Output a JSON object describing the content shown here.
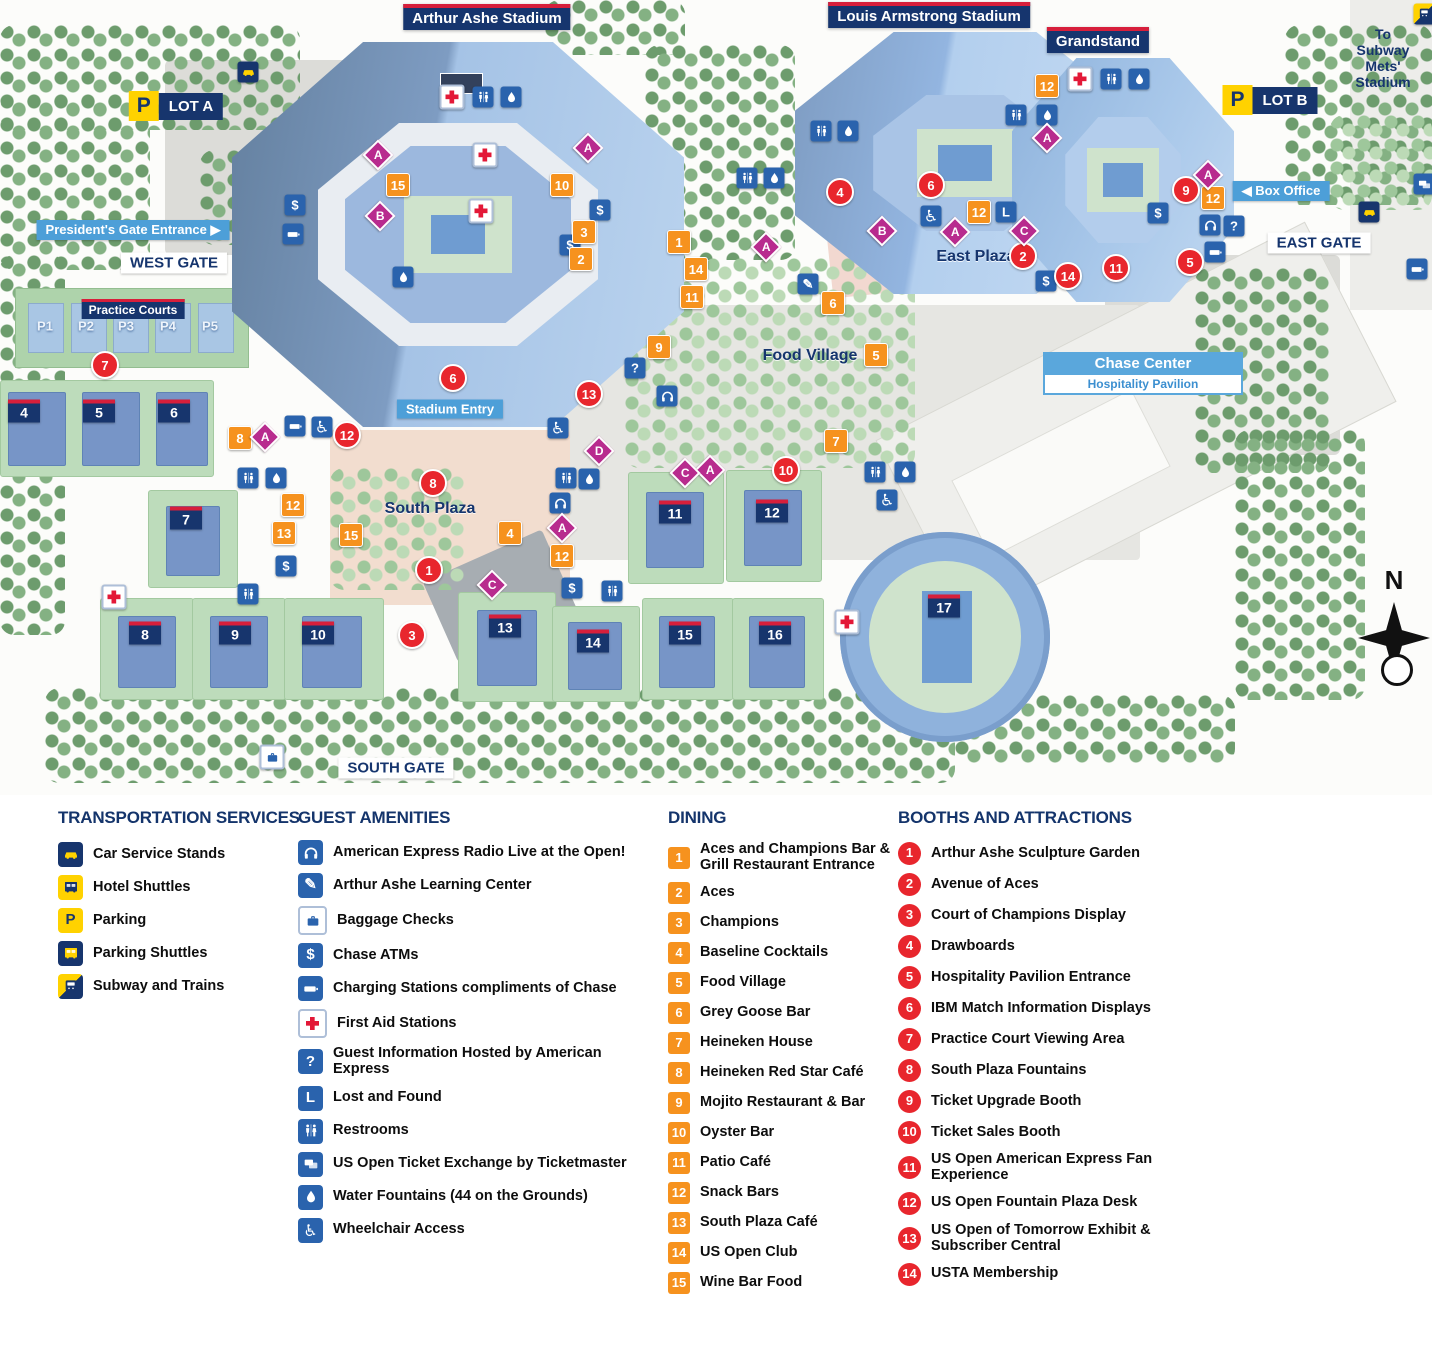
{
  "map": {
    "chase": {
      "line1": "Chase Center",
      "line2": "Hospitality Pavilion"
    },
    "compass": {
      "n": "N"
    },
    "labels": [
      {
        "id": "arthur-ashe-stadium-title",
        "style": "title",
        "text": "Arthur Ashe Stadium",
        "x": 487,
        "y": 17
      },
      {
        "id": "louis-armstrong-stadium-title",
        "style": "title",
        "text": "Louis Armstrong Stadium",
        "x": 929,
        "y": 15
      },
      {
        "id": "grandstand-title",
        "style": "title",
        "text": "Grandstand",
        "x": 1098,
        "y": 40
      },
      {
        "id": "practice-courts-title",
        "style": "title-sm",
        "text": "Practice Courts",
        "x": 133,
        "y": 309
      },
      {
        "id": "west-gate-label",
        "style": "gate",
        "text": "WEST GATE",
        "x": 174,
        "y": 263
      },
      {
        "id": "east-gate-label",
        "style": "gate",
        "text": "EAST GATE",
        "x": 1319,
        "y": 243
      },
      {
        "id": "south-gate-label",
        "style": "gate",
        "text": "SOUTH GATE",
        "x": 396,
        "y": 768
      },
      {
        "id": "presidents-gate-entrance-label",
        "style": "blue",
        "text": "President's Gate Entrance ▶",
        "x": 133,
        "y": 230
      },
      {
        "id": "stadium-entry-label",
        "style": "blue",
        "text": "Stadium Entry",
        "x": 450,
        "y": 409
      },
      {
        "id": "box-office-label",
        "style": "blue",
        "text": "◀ Box Office",
        "x": 1281,
        "y": 191
      },
      {
        "id": "east-plaza-label",
        "style": "plaza",
        "text": "East Plaza",
        "x": 976,
        "y": 257
      },
      {
        "id": "south-plaza-label",
        "style": "plaza",
        "text": "South Plaza",
        "x": 430,
        "y": 509
      },
      {
        "id": "food-village-label",
        "style": "plaza",
        "text": "Food Village",
        "x": 810,
        "y": 356
      },
      {
        "id": "to-subway-label",
        "style": "navytext",
        "text": "To Subway\nMets' Stadium",
        "x": 1383,
        "y": 58
      },
      {
        "id": "lot-a-label",
        "style": "lot",
        "text": "LOT A",
        "x": 176,
        "y": 106
      },
      {
        "id": "lot-b-label",
        "style": "lot",
        "text": "LOT B",
        "x": 1270,
        "y": 100
      }
    ],
    "courts": [
      {
        "n": "4",
        "x": 24,
        "y": 411
      },
      {
        "n": "5",
        "x": 99,
        "y": 411
      },
      {
        "n": "6",
        "x": 174,
        "y": 411
      },
      {
        "n": "7",
        "x": 186,
        "y": 518
      },
      {
        "n": "8",
        "x": 145,
        "y": 633
      },
      {
        "n": "9",
        "x": 235,
        "y": 633
      },
      {
        "n": "10",
        "x": 318,
        "y": 633
      },
      {
        "n": "11",
        "x": 675,
        "y": 512
      },
      {
        "n": "12",
        "x": 772,
        "y": 511
      },
      {
        "n": "13",
        "x": 505,
        "y": 626
      },
      {
        "n": "14",
        "x": 593,
        "y": 641
      },
      {
        "n": "15",
        "x": 685,
        "y": 633
      },
      {
        "n": "16",
        "x": 775,
        "y": 633
      },
      {
        "n": "17",
        "x": 944,
        "y": 606
      }
    ],
    "practice_courts": [
      {
        "t": "P1",
        "x": 45,
        "y": 326
      },
      {
        "t": "P2",
        "x": 86,
        "y": 326
      },
      {
        "t": "P3",
        "x": 126,
        "y": 326
      },
      {
        "t": "P4",
        "x": 168,
        "y": 326
      },
      {
        "t": "P5",
        "x": 210,
        "y": 326
      }
    ],
    "markers": [
      {
        "k": "d",
        "v": "15",
        "x": 398,
        "y": 185
      },
      {
        "k": "d",
        "v": "10",
        "x": 562,
        "y": 185
      },
      {
        "k": "d",
        "v": "3",
        "x": 584,
        "y": 232
      },
      {
        "k": "d",
        "v": "2",
        "x": 581,
        "y": 259
      },
      {
        "k": "d",
        "v": "1",
        "x": 679,
        "y": 242
      },
      {
        "k": "d",
        "v": "14",
        "x": 696,
        "y": 269
      },
      {
        "k": "d",
        "v": "11",
        "x": 692,
        "y": 297
      },
      {
        "k": "d",
        "v": "9",
        "x": 659,
        "y": 347
      },
      {
        "k": "d",
        "v": "8",
        "x": 240,
        "y": 438
      },
      {
        "k": "d",
        "v": "12",
        "x": 293,
        "y": 505
      },
      {
        "k": "d",
        "v": "13",
        "x": 284,
        "y": 533
      },
      {
        "k": "d",
        "v": "15",
        "x": 351,
        "y": 535
      },
      {
        "k": "d",
        "v": "4",
        "x": 510,
        "y": 533
      },
      {
        "k": "d",
        "v": "12",
        "x": 562,
        "y": 556
      },
      {
        "k": "d",
        "v": "6",
        "x": 833,
        "y": 303
      },
      {
        "k": "d",
        "v": "5",
        "x": 876,
        "y": 355
      },
      {
        "k": "d",
        "v": "7",
        "x": 836,
        "y": 441
      },
      {
        "k": "d",
        "v": "12",
        "x": 1047,
        "y": 86
      },
      {
        "k": "d",
        "v": "12",
        "x": 979,
        "y": 212
      },
      {
        "k": "d",
        "v": "12",
        "x": 1213,
        "y": 198
      },
      {
        "k": "b",
        "v": "7",
        "x": 105,
        "y": 365
      },
      {
        "k": "b",
        "v": "6",
        "x": 453,
        "y": 378
      },
      {
        "k": "b",
        "v": "13",
        "x": 589,
        "y": 394
      },
      {
        "k": "b",
        "v": "12",
        "x": 347,
        "y": 435
      },
      {
        "k": "b",
        "v": "8",
        "x": 433,
        "y": 483
      },
      {
        "k": "b",
        "v": "1",
        "x": 429,
        "y": 570
      },
      {
        "k": "b",
        "v": "3",
        "x": 412,
        "y": 635
      },
      {
        "k": "b",
        "v": "10",
        "x": 786,
        "y": 470
      },
      {
        "k": "b",
        "v": "4",
        "x": 840,
        "y": 192
      },
      {
        "k": "b",
        "v": "6",
        "x": 931,
        "y": 185
      },
      {
        "k": "b",
        "v": "2",
        "x": 1023,
        "y": 256
      },
      {
        "k": "b",
        "v": "14",
        "x": 1068,
        "y": 276
      },
      {
        "k": "b",
        "v": "11",
        "x": 1116,
        "y": 268
      },
      {
        "k": "b",
        "v": "9",
        "x": 1186,
        "y": 190
      },
      {
        "k": "b",
        "v": "5",
        "x": 1190,
        "y": 262
      },
      {
        "k": "a",
        "v": "firstaid",
        "x": 452,
        "y": 97
      },
      {
        "k": "a",
        "v": "firstaid",
        "x": 485,
        "y": 155
      },
      {
        "k": "a",
        "v": "firstaid",
        "x": 481,
        "y": 211
      },
      {
        "k": "a",
        "v": "firstaid",
        "x": 1080,
        "y": 79
      },
      {
        "k": "a",
        "v": "firstaid",
        "x": 114,
        "y": 597
      },
      {
        "k": "a",
        "v": "firstaid",
        "x": 847,
        "y": 622
      },
      {
        "k": "a",
        "v": "restroom",
        "x": 483,
        "y": 97
      },
      {
        "k": "a",
        "v": "restroom",
        "x": 821,
        "y": 131
      },
      {
        "k": "a",
        "v": "restroom",
        "x": 747,
        "y": 178
      },
      {
        "k": "a",
        "v": "restroom",
        "x": 1016,
        "y": 115
      },
      {
        "k": "a",
        "v": "restroom",
        "x": 1111,
        "y": 79
      },
      {
        "k": "a",
        "v": "restroom",
        "x": 248,
        "y": 478
      },
      {
        "k": "a",
        "v": "restroom",
        "x": 566,
        "y": 478
      },
      {
        "k": "a",
        "v": "restroom",
        "x": 875,
        "y": 472
      },
      {
        "k": "a",
        "v": "restroom",
        "x": 248,
        "y": 594
      },
      {
        "k": "a",
        "v": "restroom",
        "x": 612,
        "y": 591
      },
      {
        "k": "a",
        "v": "water",
        "x": 511,
        "y": 97
      },
      {
        "k": "a",
        "v": "water",
        "x": 403,
        "y": 277
      },
      {
        "k": "a",
        "v": "water",
        "x": 848,
        "y": 131
      },
      {
        "k": "a",
        "v": "water",
        "x": 774,
        "y": 178
      },
      {
        "k": "a",
        "v": "water",
        "x": 1047,
        "y": 115
      },
      {
        "k": "a",
        "v": "water",
        "x": 1139,
        "y": 79
      },
      {
        "k": "a",
        "v": "water",
        "x": 276,
        "y": 478
      },
      {
        "k": "a",
        "v": "water",
        "x": 589,
        "y": 479
      },
      {
        "k": "a",
        "v": "water",
        "x": 905,
        "y": 472
      },
      {
        "k": "a",
        "v": "atm",
        "x": 295,
        "y": 205
      },
      {
        "k": "a",
        "v": "atm",
        "x": 600,
        "y": 210
      },
      {
        "k": "a",
        "v": "atm",
        "x": 570,
        "y": 245
      },
      {
        "k": "a",
        "v": "atm",
        "x": 286,
        "y": 566
      },
      {
        "k": "a",
        "v": "atm",
        "x": 572,
        "y": 588
      },
      {
        "k": "a",
        "v": "atm",
        "x": 1046,
        "y": 281
      },
      {
        "k": "a",
        "v": "atm",
        "x": 1158,
        "y": 213
      },
      {
        "k": "a",
        "v": "charging",
        "x": 293,
        "y": 234
      },
      {
        "k": "a",
        "v": "charging",
        "x": 295,
        "y": 426
      },
      {
        "k": "a",
        "v": "charging",
        "x": 1215,
        "y": 252
      },
      {
        "k": "a",
        "v": "charging",
        "x": 1417,
        "y": 269
      },
      {
        "k": "a",
        "v": "wheelchair",
        "x": 322,
        "y": 427
      },
      {
        "k": "a",
        "v": "wheelchair",
        "x": 558,
        "y": 428
      },
      {
        "k": "a",
        "v": "wheelchair",
        "x": 931,
        "y": 216
      },
      {
        "k": "a",
        "v": "wheelchair",
        "x": 887,
        "y": 500
      },
      {
        "k": "a",
        "v": "radio",
        "x": 667,
        "y": 396
      },
      {
        "k": "a",
        "v": "radio",
        "x": 560,
        "y": 503
      },
      {
        "k": "a",
        "v": "radio",
        "x": 1210,
        "y": 225
      },
      {
        "k": "a",
        "v": "guestinfo",
        "x": 635,
        "y": 368
      },
      {
        "k": "a",
        "v": "guestinfo",
        "x": 1234,
        "y": 226
      },
      {
        "k": "a",
        "v": "lost",
        "x": 1006,
        "y": 212
      },
      {
        "k": "a",
        "v": "learning",
        "x": 808,
        "y": 284
      },
      {
        "k": "a",
        "v": "baggage",
        "x": 272,
        "y": 757
      },
      {
        "k": "a",
        "v": "ticketex",
        "x": 1424,
        "y": 184
      },
      {
        "k": "a",
        "v": "taxi",
        "x": 248,
        "y": 72
      },
      {
        "k": "a",
        "v": "taxi",
        "x": 1369,
        "y": 212
      },
      {
        "k": "a",
        "v": "subway",
        "x": 1424,
        "y": 14
      },
      {
        "k": "l",
        "v": "A",
        "x": 378,
        "y": 155
      },
      {
        "k": "l",
        "v": "A",
        "x": 588,
        "y": 148
      },
      {
        "k": "l",
        "v": "A",
        "x": 265,
        "y": 437
      },
      {
        "k": "l",
        "v": "A",
        "x": 562,
        "y": 528
      },
      {
        "k": "l",
        "v": "A",
        "x": 710,
        "y": 470
      },
      {
        "k": "l",
        "v": "A",
        "x": 766,
        "y": 247
      },
      {
        "k": "l",
        "v": "A",
        "x": 955,
        "y": 232
      },
      {
        "k": "l",
        "v": "A",
        "x": 1047,
        "y": 138
      },
      {
        "k": "l",
        "v": "A",
        "x": 1208,
        "y": 175
      },
      {
        "k": "l",
        "v": "B",
        "x": 380,
        "y": 216
      },
      {
        "k": "l",
        "v": "B",
        "x": 882,
        "y": 231
      },
      {
        "k": "l",
        "v": "C",
        "x": 685,
        "y": 473
      },
      {
        "k": "l",
        "v": "C",
        "x": 492,
        "y": 585
      },
      {
        "k": "l",
        "v": "C",
        "x": 1024,
        "y": 231
      },
      {
        "k": "l",
        "v": "D",
        "x": 599,
        "y": 451
      }
    ]
  },
  "legend": {
    "transportation": {
      "title": "TRANSPORTATION SERVICES",
      "items": [
        {
          "icon": "car-service",
          "label": "Car Service Stands"
        },
        {
          "icon": "hotel-shuttle",
          "label": "Hotel Shuttles"
        },
        {
          "icon": "parking",
          "label": "Parking"
        },
        {
          "icon": "parking-shuttle",
          "label": "Parking Shuttles"
        },
        {
          "icon": "subway",
          "label": "Subway and Trains"
        }
      ]
    },
    "guest": {
      "title": "GUEST AMENITIES",
      "items": [
        {
          "icon": "radio",
          "label": "American Express Radio Live at the Open!"
        },
        {
          "icon": "learning",
          "label": "Arthur Ashe Learning Center"
        },
        {
          "icon": "baggage",
          "label": "Baggage Checks"
        },
        {
          "icon": "atm",
          "label": "Chase ATMs"
        },
        {
          "icon": "charging",
          "label": "Charging Stations compliments of Chase"
        },
        {
          "icon": "firstaid",
          "label": "First Aid Stations"
        },
        {
          "icon": "guestinfo",
          "label": "Guest Information Hosted by American Express"
        },
        {
          "icon": "lost",
          "label": "Lost and Found"
        },
        {
          "icon": "restroom",
          "label": "Restrooms"
        },
        {
          "icon": "ticketex",
          "label": "US Open Ticket Exchange by Ticketmaster"
        },
        {
          "icon": "water",
          "label": "Water Fountains (44 on the Grounds)"
        },
        {
          "icon": "wheelchair",
          "label": "Wheelchair Access"
        }
      ]
    },
    "dining": {
      "title": "DINING",
      "items": [
        {
          "num": "1",
          "label": "Aces and Champions Bar & Grill Restaurant Entrance"
        },
        {
          "num": "2",
          "label": "Aces"
        },
        {
          "num": "3",
          "label": "Champions"
        },
        {
          "num": "4",
          "label": "Baseline Cocktails"
        },
        {
          "num": "5",
          "label": "Food Village"
        },
        {
          "num": "6",
          "label": "Grey Goose Bar"
        },
        {
          "num": "7",
          "label": "Heineken House"
        },
        {
          "num": "8",
          "label": "Heineken Red Star Café"
        },
        {
          "num": "9",
          "label": "Mojito Restaurant & Bar"
        },
        {
          "num": "10",
          "label": "Oyster Bar"
        },
        {
          "num": "11",
          "label": "Patio Café"
        },
        {
          "num": "12",
          "label": "Snack Bars"
        },
        {
          "num": "13",
          "label": "South Plaza Café"
        },
        {
          "num": "14",
          "label": "US Open Club"
        },
        {
          "num": "15",
          "label": "Wine Bar Food"
        }
      ]
    },
    "booths": {
      "title": "BOOTHS AND ATTRACTIONS",
      "items": [
        {
          "num": "1",
          "label": "Arthur Ashe Sculpture Garden"
        },
        {
          "num": "2",
          "label": "Avenue of Aces"
        },
        {
          "num": "3",
          "label": "Court of Champions Display"
        },
        {
          "num": "4",
          "label": "Drawboards"
        },
        {
          "num": "5",
          "label": "Hospitality Pavilion Entrance"
        },
        {
          "num": "6",
          "label": "IBM Match Information Displays"
        },
        {
          "num": "7",
          "label": "Practice Court Viewing Area"
        },
        {
          "num": "8",
          "label": "South Plaza Fountains"
        },
        {
          "num": "9",
          "label": "Ticket Upgrade Booth"
        },
        {
          "num": "10",
          "label": "Ticket Sales Booth"
        },
        {
          "num": "11",
          "label": "US Open American Express Fan Experience"
        },
        {
          "num": "12",
          "label": "US Open Fountain Plaza Desk"
        },
        {
          "num": "13",
          "label": "US Open of Tomorrow Exhibit & Subscriber Central"
        },
        {
          "num": "14",
          "label": "USTA Membership"
        }
      ]
    }
  },
  "colors": {
    "navy": "#16356e",
    "red_bar": "#d71f3b",
    "orange": "#f6921e",
    "booth_red": "#e8262d",
    "icon_blue": "#2a63ad",
    "light_blue": "#4d9fd8",
    "diamond_pink": "#b82b8e",
    "yellow": "#ffd200"
  }
}
